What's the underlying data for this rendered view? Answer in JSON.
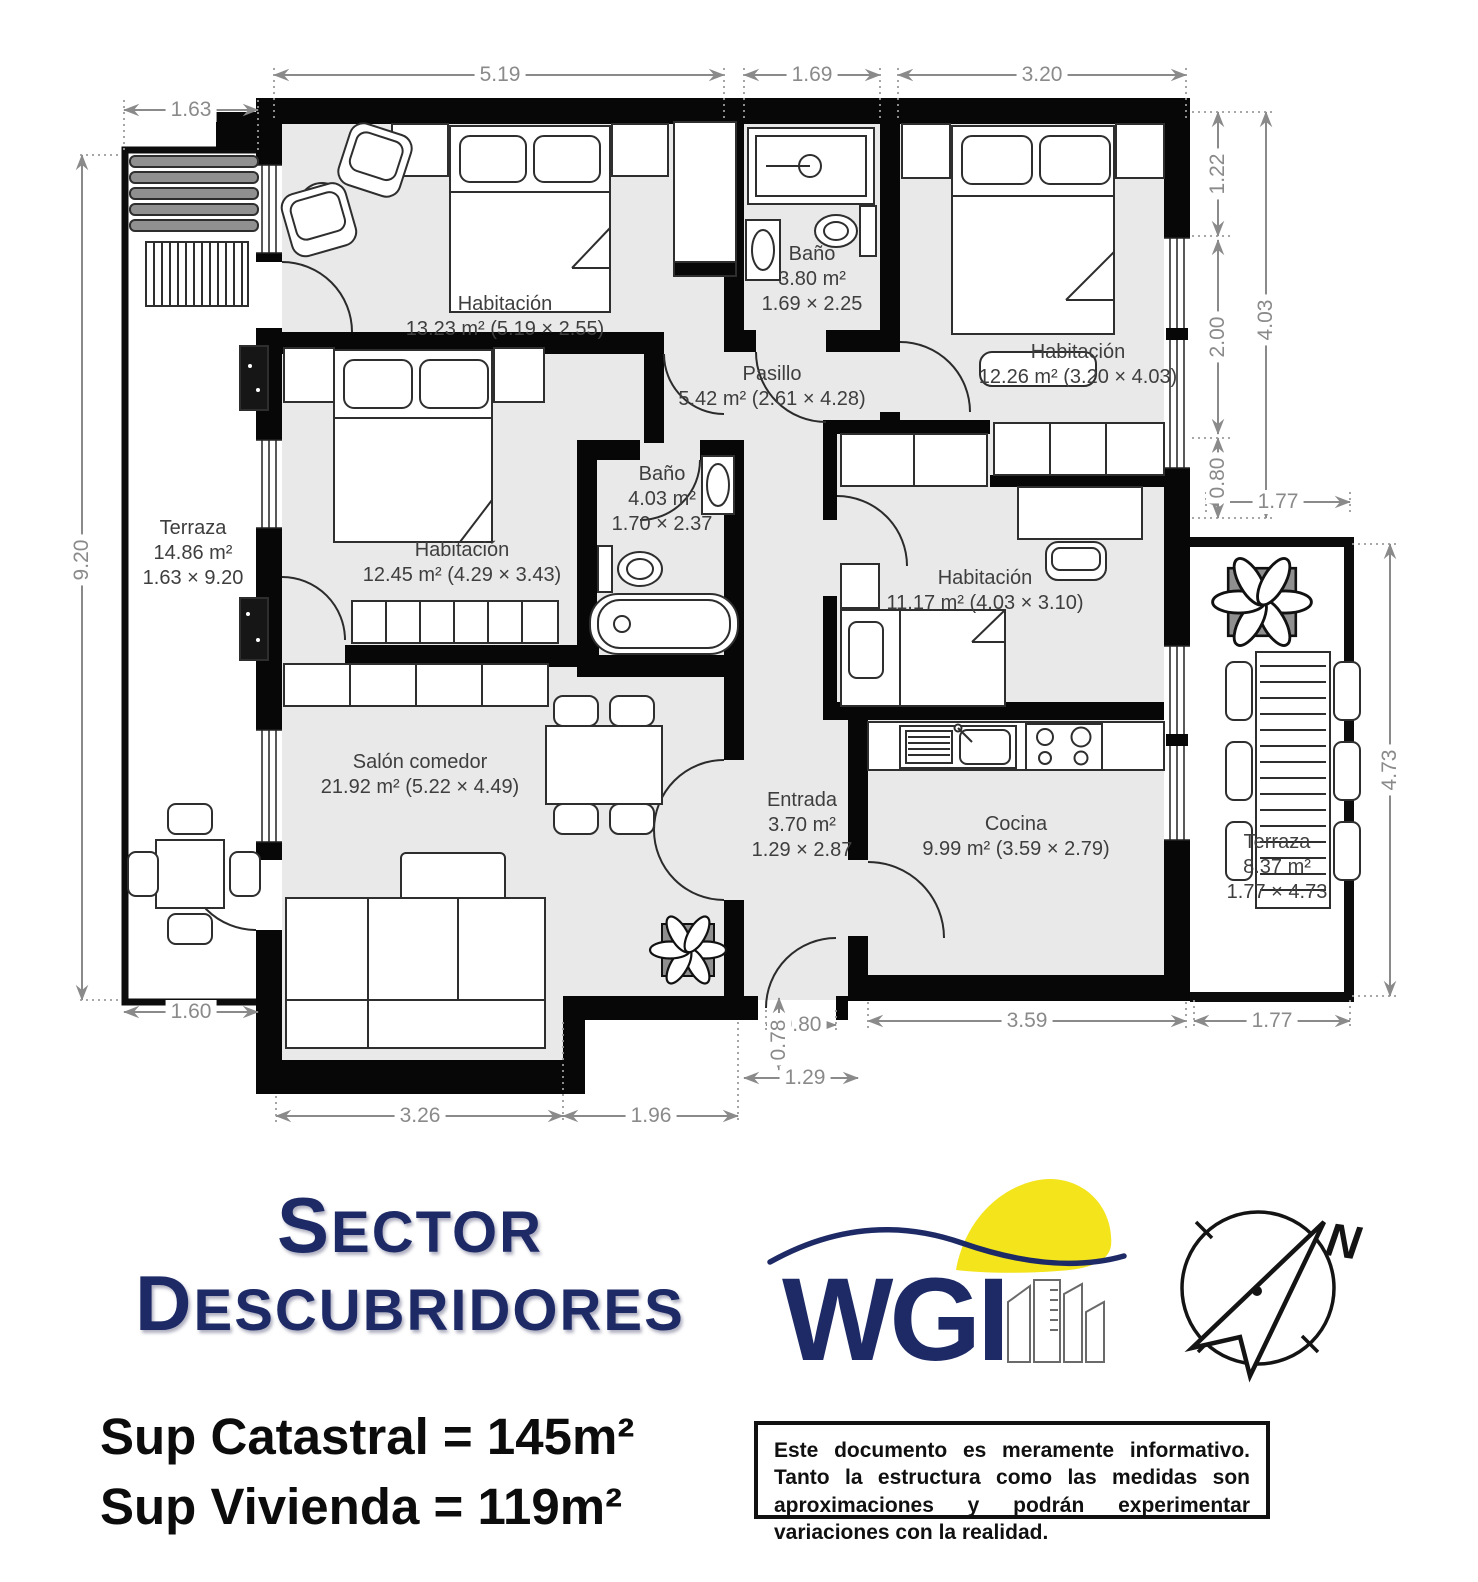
{
  "colors": {
    "navy": "#1d2a66",
    "yellow": "#f3e41c",
    "floor_gray": "#e9e9e9",
    "wall_black": "#070707",
    "dimension_gray": "#8a8a8a"
  },
  "rooms": [
    {
      "name": "Habitación",
      "line2": "13.23 m² (5.19 × 2.55)"
    },
    {
      "name": "Baño",
      "line2": "3.80 m²",
      "line3": "1.69 × 2.25"
    },
    {
      "name": "Habitación",
      "line2": "12.26 m² (3.20 × 4.03)"
    },
    {
      "name": "Pasillo",
      "line2": "5.42 m² (2.61 × 4.28)"
    },
    {
      "name": "Habitación",
      "line2": "12.45 m² (4.29 × 3.43)"
    },
    {
      "name": "Baño",
      "line2": "4.03 m²",
      "line3": "1.70 × 2.37"
    },
    {
      "name": "Habitación",
      "line2": "11.17 m² (4.03 × 3.10)"
    },
    {
      "name": "Salón comedor",
      "line2": "21.92 m² (5.22 × 4.49)"
    },
    {
      "name": "Entrada",
      "line2": "3.70 m²",
      "line3": "1.29 × 2.87"
    },
    {
      "name": "Cocina",
      "line2": "9.99 m² (3.59 × 2.79)"
    },
    {
      "name": "Terraza",
      "line2": "14.86 m²",
      "line3": "1.63 × 9.20"
    },
    {
      "name": "Terraza",
      "line2": "8.37 m²",
      "line3": "1.77 × 4.73"
    }
  ],
  "dimensions": {
    "top_room1": "5.19",
    "top_bath": "1.69",
    "top_room2": "3.20",
    "terrace_left_width": "1.63",
    "terrace_left_height": "9.20",
    "right_seg1": "1.22",
    "right_seg2": "2.00",
    "right_seg3": "0.80",
    "right_total": "4.03",
    "terrace_right_top": "1.77",
    "terrace_right_height": "4.73",
    "terrace_right_bottom": "1.77",
    "kitchen_bottom": "3.59",
    "entry_door": "0.80",
    "entry_depth": "0.78",
    "entry_width": "1.29",
    "salon_bottom_left": "3.26",
    "salon_bottom_right": "1.96",
    "terrace_left_bottom": "1.60"
  },
  "footer": {
    "sector_line1": {
      "initial": "S",
      "rest": "ECTOR"
    },
    "sector_line2": {
      "initial": "D",
      "rest": "ESCUBRIDORES"
    },
    "sup_catastral": "Sup Catastral = 145m²",
    "sup_vivienda": "Sup Vivienda = 119m²",
    "logo_text": "WGI",
    "compass_north": "N",
    "disclaimer": "Este documento es meramente informativo. Tanto la estructura como las medidas son aproximaciones y podrán experimentar variaciones con la realidad."
  }
}
